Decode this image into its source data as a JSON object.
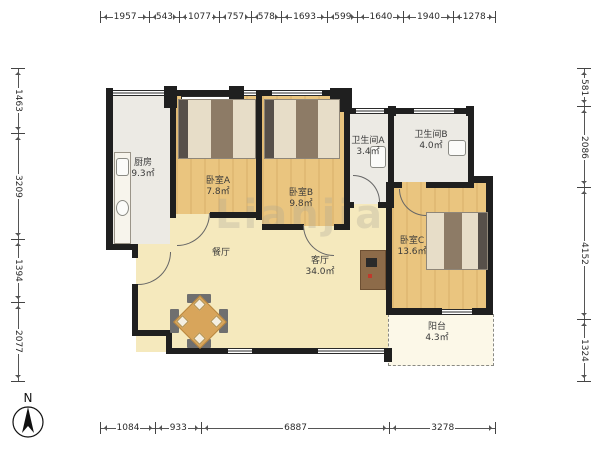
{
  "meta": {
    "type": "apartment-floor-plan"
  },
  "watermark": {
    "text": "Lianjia"
  },
  "compass": {
    "label": "N"
  },
  "dimensions": {
    "top": [
      "1957",
      "543",
      "1077",
      "757",
      "578",
      "1693",
      "599",
      "1640",
      "1940",
      "1278"
    ],
    "bottom": [
      "1084",
      "933",
      "6887",
      "3278"
    ],
    "left": [
      "1463",
      "3209",
      "1394",
      "2077"
    ],
    "right": [
      "581",
      "2086",
      "4152",
      "1324"
    ]
  },
  "rooms": {
    "kitchen": {
      "name": "厨房",
      "area": "9.3㎡"
    },
    "bedroom_a": {
      "name": "卧室A",
      "area": "7.8㎡"
    },
    "bedroom_b": {
      "name": "卧室B",
      "area": "9.8㎡"
    },
    "bathroom_a": {
      "name": "卫生间A",
      "area": "3.4㎡"
    },
    "bathroom_b": {
      "name": "卫生间B",
      "area": "4.0㎡"
    },
    "bedroom_c": {
      "name": "卧室C",
      "area": "13.6㎡"
    },
    "dining": {
      "name": "餐厅",
      "area": ""
    },
    "living": {
      "name": "客厅",
      "area": "34.0㎡"
    },
    "balcony": {
      "name": "阳台",
      "area": "4.3㎡"
    }
  },
  "colors": {
    "wall": "#1f1f1f",
    "wood_floor": "#eac57f",
    "living_floor": "#f5e9bd",
    "tile_floor": "#eceae4",
    "balcony_floor": "#fcf8e8"
  }
}
